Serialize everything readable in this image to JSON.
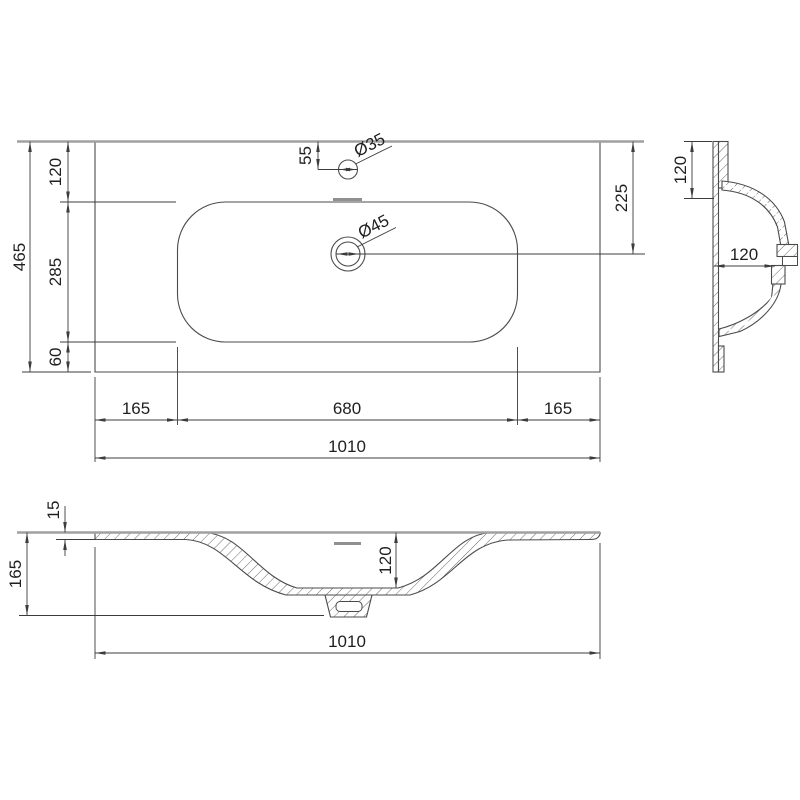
{
  "drawing": {
    "type": "technical-dimensional-drawing",
    "subject": "washbasin countertop",
    "units": "mm",
    "colors": {
      "object_line": "#4b4b4b",
      "dimension_line": "#3c3c3c",
      "surface_edge": "#a0a0a0",
      "text": "#1f1f1f",
      "background": "#ffffff"
    }
  },
  "plan_view": {
    "dim_total_depth": "465",
    "dim_front_to_basin": "120",
    "dim_basin_depth": "285",
    "dim_basin_to_back": "60",
    "dim_faucet_offset": "55",
    "dim_faucet_diameter": "Ø35",
    "dim_drain_diameter": "Ø45",
    "dim_top_to_drain": "225",
    "dim_left_margin": "165",
    "dim_basin_width": "680",
    "dim_right_margin": "165",
    "dim_total_width": "1010"
  },
  "side_section": {
    "dim_top_edge_to_basin": "120",
    "dim_basin_depth": "120"
  },
  "front_section": {
    "dim_rim_thickness": "15",
    "dim_total_height": "165",
    "dim_bowl_depth": "120",
    "dim_total_width": "1010"
  }
}
